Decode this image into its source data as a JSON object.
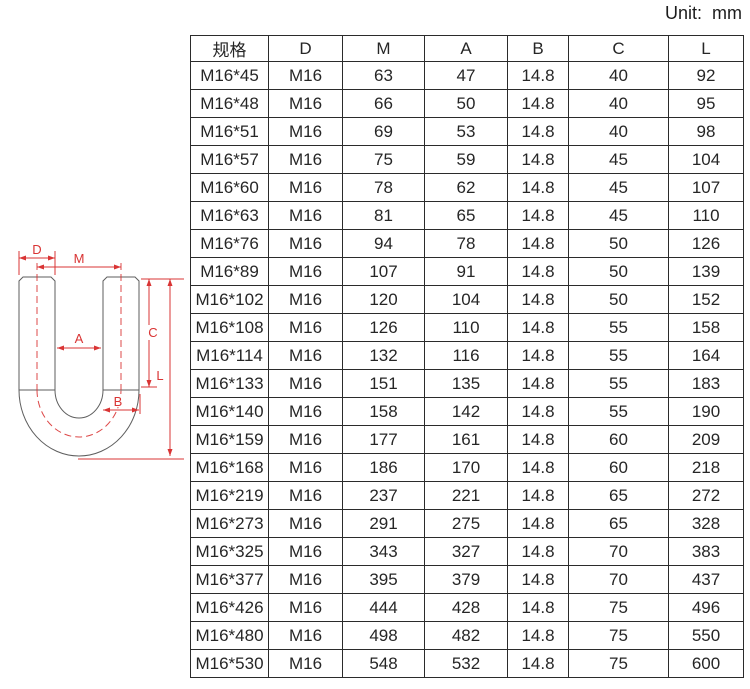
{
  "unit_label": "Unit:  mm",
  "table": {
    "border_color": "#2b2b2b",
    "text_color": "#262626",
    "headers": [
      "规格",
      "D",
      "M",
      "A",
      "B",
      "C",
      "L"
    ],
    "rows": [
      [
        "M16*45",
        "M16",
        "63",
        "47",
        "14.8",
        "40",
        "92"
      ],
      [
        "M16*48",
        "M16",
        "66",
        "50",
        "14.8",
        "40",
        "95"
      ],
      [
        "M16*51",
        "M16",
        "69",
        "53",
        "14.8",
        "40",
        "98"
      ],
      [
        "M16*57",
        "M16",
        "75",
        "59",
        "14.8",
        "45",
        "104"
      ],
      [
        "M16*60",
        "M16",
        "78",
        "62",
        "14.8",
        "45",
        "107"
      ],
      [
        "M16*63",
        "M16",
        "81",
        "65",
        "14.8",
        "45",
        "110"
      ],
      [
        "M16*76",
        "M16",
        "94",
        "78",
        "14.8",
        "50",
        "126"
      ],
      [
        "M16*89",
        "M16",
        "107",
        "91",
        "14.8",
        "50",
        "139"
      ],
      [
        "M16*102",
        "M16",
        "120",
        "104",
        "14.8",
        "50",
        "152"
      ],
      [
        "M16*108",
        "M16",
        "126",
        "110",
        "14.8",
        "55",
        "158"
      ],
      [
        "M16*114",
        "M16",
        "132",
        "116",
        "14.8",
        "55",
        "164"
      ],
      [
        "M16*133",
        "M16",
        "151",
        "135",
        "14.8",
        "55",
        "183"
      ],
      [
        "M16*140",
        "M16",
        "158",
        "142",
        "14.8",
        "55",
        "190"
      ],
      [
        "M16*159",
        "M16",
        "177",
        "161",
        "14.8",
        "60",
        "209"
      ],
      [
        "M16*168",
        "M16",
        "186",
        "170",
        "14.8",
        "60",
        "218"
      ],
      [
        "M16*219",
        "M16",
        "237",
        "221",
        "14.8",
        "65",
        "272"
      ],
      [
        "M16*273",
        "M16",
        "291",
        "275",
        "14.8",
        "65",
        "328"
      ],
      [
        "M16*325",
        "M16",
        "343",
        "327",
        "14.8",
        "70",
        "383"
      ],
      [
        "M16*377",
        "M16",
        "395",
        "379",
        "14.8",
        "70",
        "437"
      ],
      [
        "M16*426",
        "M16",
        "444",
        "428",
        "14.8",
        "75",
        "496"
      ],
      [
        "M16*480",
        "M16",
        "498",
        "482",
        "14.8",
        "75",
        "550"
      ],
      [
        "M16*530",
        "M16",
        "548",
        "532",
        "14.8",
        "75",
        "600"
      ]
    ]
  },
  "diagram": {
    "dimension_color": "#d93434",
    "outline_color": "#5e5e5e",
    "labels": {
      "D": "D",
      "M": "M",
      "A": "A",
      "B": "B",
      "C": "C",
      "L": "L"
    }
  }
}
